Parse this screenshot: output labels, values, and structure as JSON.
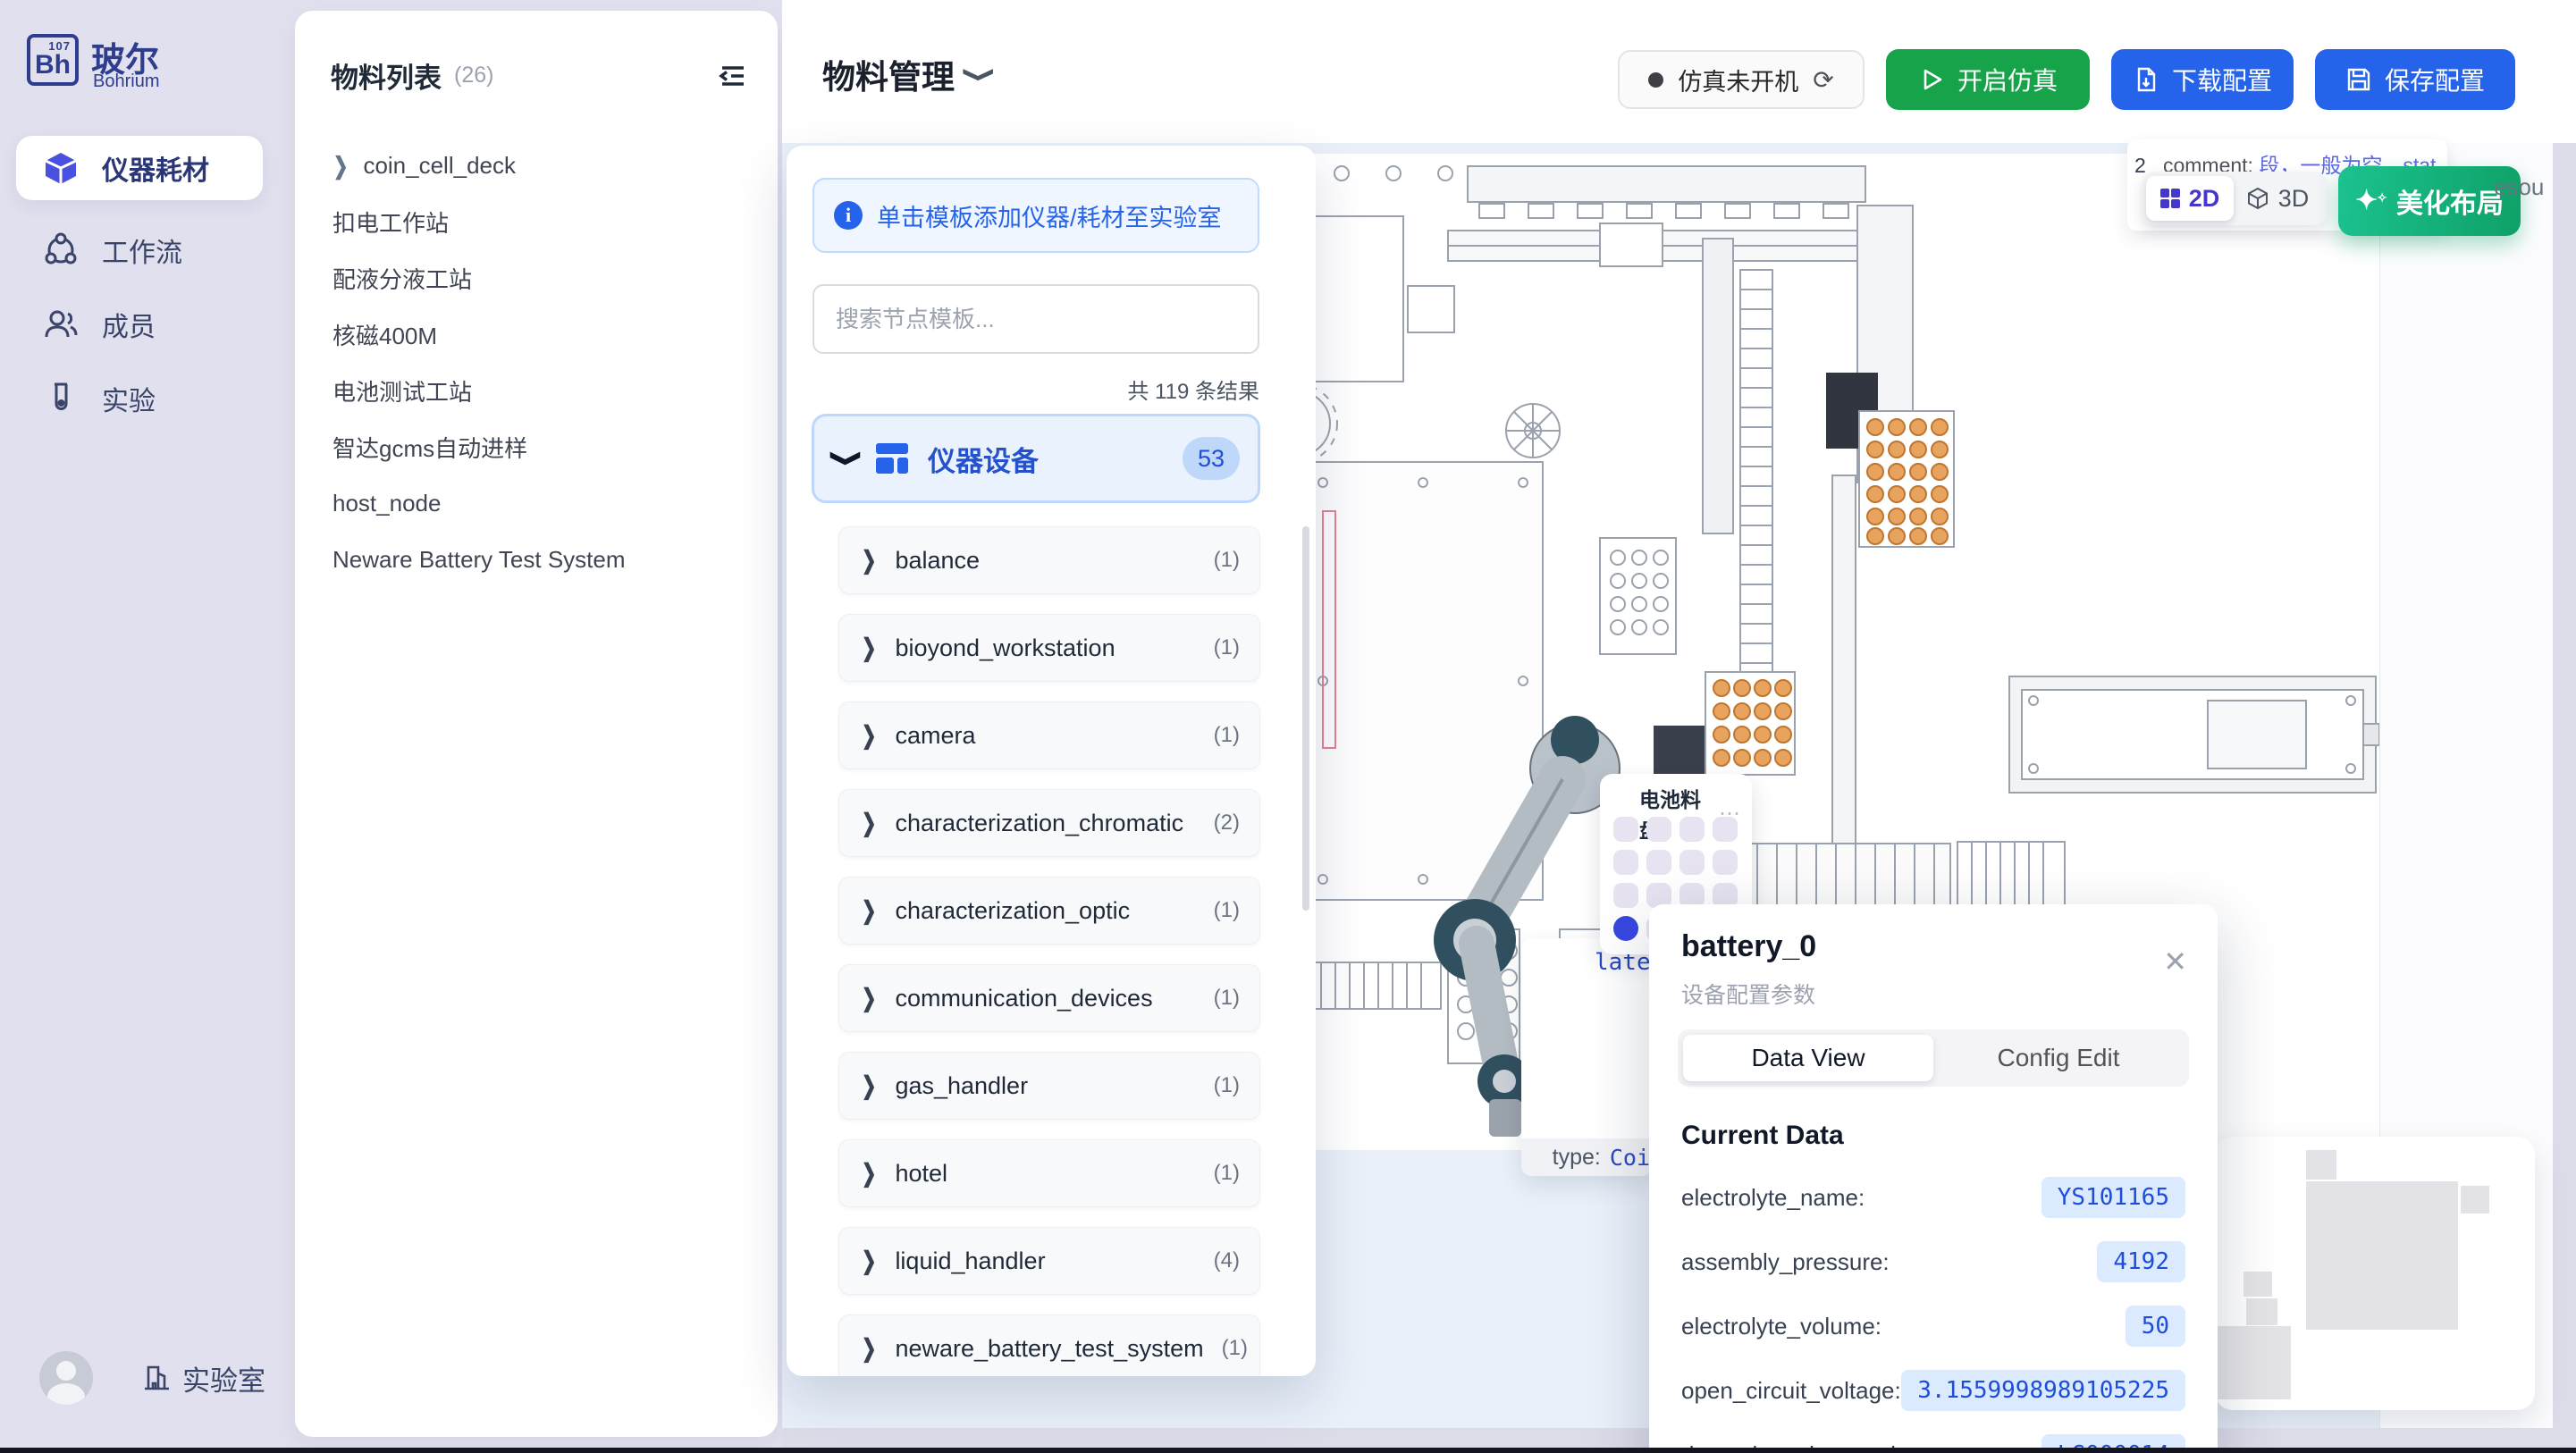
{
  "sidebar": {
    "logo": {
      "symbol": "Bh",
      "number": "107",
      "title": "玻尔",
      "subtitle": "Bohrium"
    },
    "items": [
      {
        "label": "仪器耗材",
        "icon": "cube-icon",
        "active": true
      },
      {
        "label": "工作流",
        "icon": "workflow-icon",
        "active": false
      },
      {
        "label": "成员",
        "icon": "members-icon",
        "active": false
      },
      {
        "label": "实验",
        "icon": "experiment-icon",
        "active": false
      }
    ],
    "footer": {
      "label": "实验室"
    }
  },
  "material_panel": {
    "title": "物料列表",
    "count": "(26)",
    "items": [
      {
        "label": "coin_cell_deck",
        "expandable": true
      },
      {
        "label": "扣电工作站",
        "expandable": false
      },
      {
        "label": "配液分液工站",
        "expandable": false
      },
      {
        "label": "核磁400M",
        "expandable": false
      },
      {
        "label": "电池测试工站",
        "expandable": false
      },
      {
        "label": "智达gcms自动进样",
        "expandable": false
      },
      {
        "label": "host_node",
        "expandable": false
      },
      {
        "label": "Neware Battery Test System",
        "expandable": false
      }
    ]
  },
  "header": {
    "title": "物料管理",
    "status": {
      "label": "仿真未开机"
    },
    "buttons": {
      "start": "开启仿真",
      "download": "下载配置",
      "save": "保存配置"
    }
  },
  "template_panel": {
    "banner": "单击模板添加仪器/耗材至实验室",
    "search_placeholder": "搜索节点模板...",
    "results": "共 119 条结果",
    "section": {
      "label": "仪器设备",
      "count": "53"
    },
    "items": [
      {
        "label": "balance",
        "count": "(1)"
      },
      {
        "label": "bioyond_workstation",
        "count": "(1)"
      },
      {
        "label": "camera",
        "count": "(1)"
      },
      {
        "label": "characterization_chromatic",
        "count": "(2)"
      },
      {
        "label": "characterization_optic",
        "count": "(1)"
      },
      {
        "label": "communication_devices",
        "count": "(1)"
      },
      {
        "label": "gas_handler",
        "count": "(1)"
      },
      {
        "label": "hotel",
        "count": "(1)"
      },
      {
        "label": "liquid_handler",
        "count": "(4)"
      },
      {
        "label": "neware_battery_test_system",
        "count": "(1)"
      }
    ]
  },
  "canvas": {
    "comment_tooltip": {
      "prefix": "2",
      "key": "_comment:",
      "value": "段，一般为空，stat",
      "value_line2": "达后固定"
    },
    "view_toggle": {
      "d2": "2D",
      "d3": "3D"
    },
    "beautify_label": "美化布局",
    "resource_fragment": "esou",
    "tray": {
      "title": "电池料盘",
      "menu_icon": "⋯",
      "cells": [
        "empty",
        "empty",
        "empty",
        "empty",
        "empty",
        "empty",
        "empty",
        "empty",
        "empty",
        "empty",
        "empty",
        "empty",
        "active",
        "empty",
        "empty",
        "empty"
      ]
    },
    "node_tooltip": {
      "value_fragment": "late",
      "type_label": "type:",
      "type_value": "Coi"
    }
  },
  "battery_panel": {
    "title": "battery_0",
    "subtitle": "设备配置参数",
    "close_icon": "✕",
    "tabs": [
      {
        "label": "Data View",
        "active": true
      },
      {
        "label": "Config Edit",
        "active": false
      }
    ],
    "section": "Current Data",
    "fields": [
      {
        "label": "electrolyte_name:",
        "value": "YS101165"
      },
      {
        "label": "assembly_pressure:",
        "value": "4192"
      },
      {
        "label": "electrolyte_volume:",
        "value": "50"
      },
      {
        "label": "open_circuit_voltage:",
        "value": "3.1559998989105225"
      },
      {
        "label": "data_electrolyte_code:",
        "value": "LG000014"
      }
    ]
  },
  "colors": {
    "accent_blue": "#2563EB",
    "green": "#16A34A",
    "teal_gradient_start": "#1CC290",
    "teal_gradient_end": "#0EA167",
    "indigo": "#4338CA",
    "sidebar_bg": "#E0E0EE",
    "canvas_bg": "#E9F0F9",
    "value_chip_bg": "#DBEAFE",
    "value_chip_text": "#1D4ED8",
    "tray_slot": "#E7E3F1",
    "tray_active": "#3847E0"
  }
}
